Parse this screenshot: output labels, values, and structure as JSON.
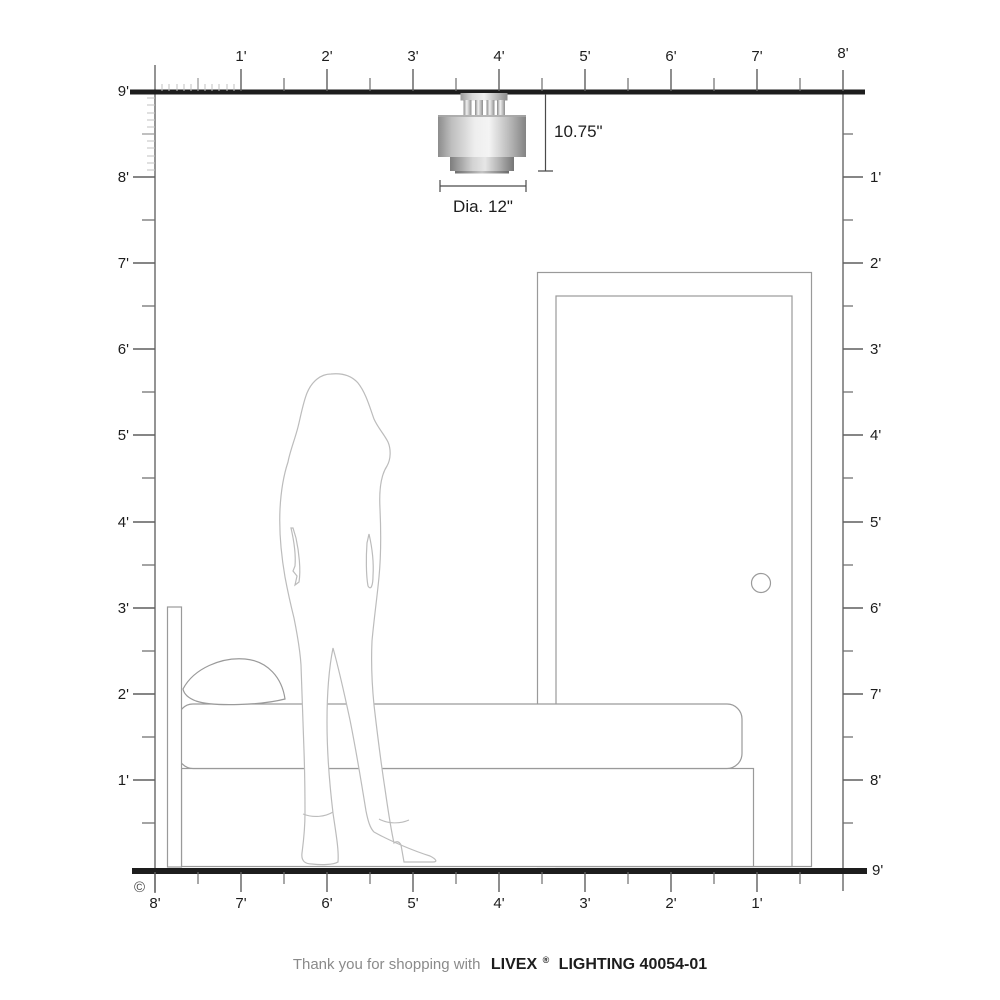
{
  "title": "Livex Lighting 40054-01 room scale diagram",
  "colors": {
    "background": "#ffffff",
    "frame": "#1d1d1d",
    "ticks": "#5f5f5f",
    "minor_ticks": "#c0c0c0",
    "drawing_outline": "#9a9a9a",
    "silhouette_outline": "#bcbcbc",
    "dimension": "#4a4a4a"
  },
  "fixture": {
    "type": "flush mount ceiling light",
    "height_label": "10.75\"",
    "diameter_label": "Dia. 12\""
  },
  "rulers": {
    "unit": "feet",
    "top": {
      "labels": [
        "1'",
        "2'",
        "3'",
        "4'",
        "5'",
        "6'",
        "7'",
        "8'"
      ]
    },
    "left": {
      "labels": [
        "9'",
        "8'",
        "7'",
        "6'",
        "5'",
        "4'",
        "3'",
        "2'",
        "1'"
      ]
    },
    "right": {
      "labels": [
        "1'",
        "2'",
        "3'",
        "4'",
        "5'",
        "6'",
        "7'",
        "8'",
        "9'"
      ]
    },
    "bottom": {
      "labels": [
        "8'",
        "7'",
        "6'",
        "5'",
        "4'",
        "3'",
        "2'",
        "1'"
      ]
    }
  },
  "scene": {
    "objects": [
      "ceiling light fixture",
      "standing woman silhouette",
      "bed with headboard and pillow",
      "door with knob"
    ]
  },
  "copyright": "©",
  "footer": {
    "prefix": "Thank you for shopping with",
    "brand": "LIVEX",
    "registered": "®",
    "suffix": "LIGHTING 40054-01"
  }
}
